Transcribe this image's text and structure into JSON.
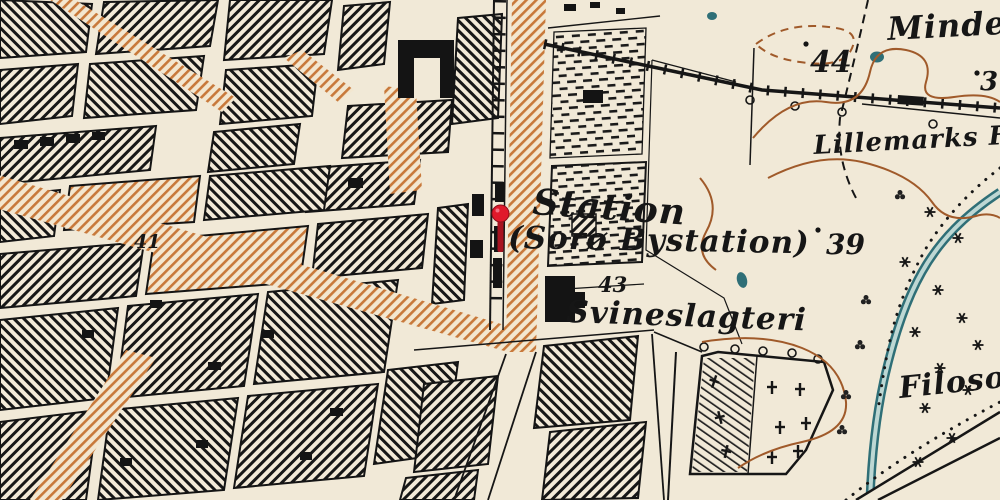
{
  "map": {
    "labels": [
      {
        "id": "mindest",
        "text": "Mindest",
        "x": 888,
        "y": 40,
        "size": 32,
        "rotate": -3,
        "style": "place"
      },
      {
        "id": "elev-44",
        "text": "44",
        "x": 810,
        "y": 72,
        "size": 30,
        "rotate": 0,
        "style": "elevation"
      },
      {
        "id": "elev-3",
        "text": "3",
        "x": 980,
        "y": 90,
        "size": 26,
        "rotate": 0,
        "style": "elevation"
      },
      {
        "id": "lillemarks",
        "text": "Lillemarks F",
        "x": 814,
        "y": 154,
        "size": 26,
        "rotate": -3,
        "style": "place"
      },
      {
        "id": "elev-39",
        "text": "39",
        "x": 826,
        "y": 254,
        "size": 28,
        "rotate": 0,
        "style": "elevation"
      },
      {
        "id": "station",
        "text": "Station",
        "x": 532,
        "y": 214,
        "size": 36,
        "rotate": 4,
        "style": "place"
      },
      {
        "id": "bystation",
        "text": "(Sorø Bystation)",
        "x": 508,
        "y": 248,
        "size": 31,
        "rotate": 1,
        "style": "place"
      },
      {
        "id": "elev-43",
        "text": "43",
        "x": 598,
        "y": 292,
        "size": 21,
        "rotate": 0,
        "style": "elevation"
      },
      {
        "id": "svineslagteri",
        "text": "Svineslagteri",
        "x": 566,
        "y": 322,
        "size": 31,
        "rotate": 2,
        "style": "place"
      },
      {
        "id": "elev-41",
        "text": "41",
        "x": 134,
        "y": 248,
        "size": 19,
        "rotate": 0,
        "style": "elevation"
      },
      {
        "id": "filoso",
        "text": "Filoso",
        "x": 900,
        "y": 398,
        "size": 30,
        "rotate": -6,
        "style": "place"
      }
    ],
    "marker": {
      "color": "#e0192b",
      "stem_color": "#a81320",
      "highlight": "#f' ",
      "x": 500,
      "y": 213
    },
    "palette": {
      "paper": "#f1e9d7",
      "ink": "#161616",
      "road_orange": "#c8793b",
      "contour_brown": "#a05a2a",
      "water": "#2f6f77",
      "water_light": "#bdd7d3"
    }
  }
}
